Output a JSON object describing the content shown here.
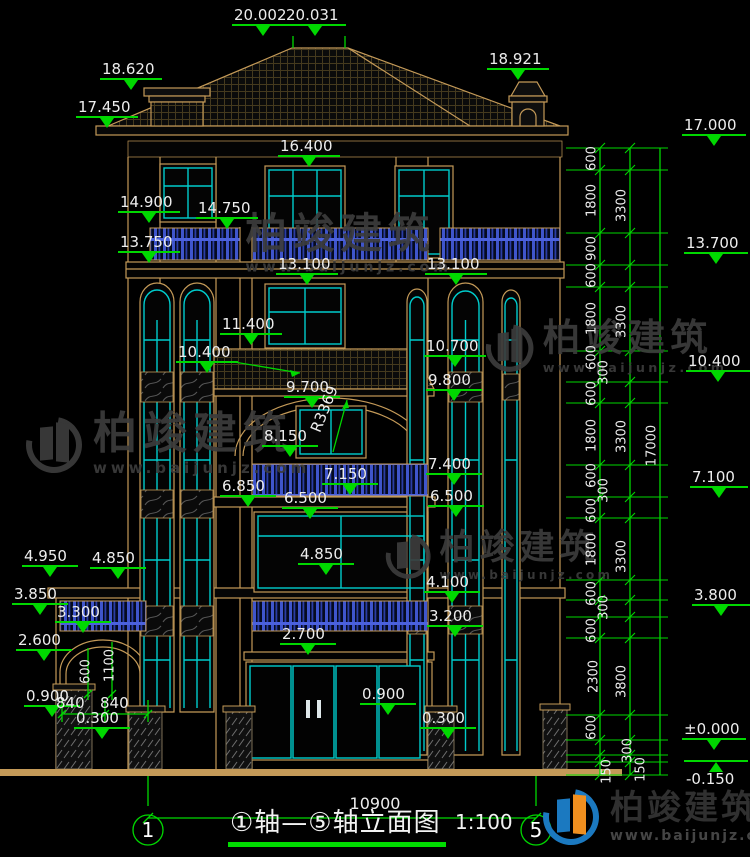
{
  "meta": {
    "drawing_type": "elevation",
    "bottom_dim": "10900"
  },
  "title": {
    "cn": "①轴—⑤轴立面图",
    "scale": "1:100",
    "axis_left": "1",
    "axis_right": "5"
  },
  "colors": {
    "background": "#000000",
    "dim_green": "#00d800",
    "line_tan": "#c49a58",
    "window_cyan": "#00cccc",
    "baluster_blue": "#3f55cc",
    "text_white": "#ededed",
    "watermark_gray": "#3c3c3c",
    "logo_blue": "#1b79c0",
    "logo_orange": "#ef8f1f"
  },
  "elevation_markers": [
    {
      "label": "20.002",
      "x": 232,
      "y": 8
    },
    {
      "label": "20.031",
      "x": 284,
      "y": 8
    },
    {
      "label": "18.620",
      "x": 100,
      "y": 62
    },
    {
      "label": "18.921",
      "x": 487,
      "y": 52
    },
    {
      "label": "17.450",
      "x": 76,
      "y": 100
    },
    {
      "label": "16.400",
      "x": 278,
      "y": 139
    },
    {
      "label": "14.900",
      "x": 118,
      "y": 195
    },
    {
      "label": "14.750",
      "x": 196,
      "y": 201
    },
    {
      "label": "13.750",
      "x": 118,
      "y": 235
    },
    {
      "label": "13.100",
      "x": 276,
      "y": 257
    },
    {
      "label": "13.100",
      "x": 425,
      "y": 257
    },
    {
      "label": "11.400",
      "x": 220,
      "y": 317
    },
    {
      "label": "10.400",
      "x": 176,
      "y": 345
    },
    {
      "label": "10.700",
      "x": 424,
      "y": 339
    },
    {
      "label": "9.800",
      "x": 426,
      "y": 373,
      "w": 56
    },
    {
      "label": "9.700",
      "x": 284,
      "y": 380,
      "w": 56
    },
    {
      "label": "8.150",
      "x": 262,
      "y": 429,
      "w": 56
    },
    {
      "label": "7.400",
      "x": 426,
      "y": 457,
      "w": 56
    },
    {
      "label": "7.150",
      "x": 322,
      "y": 467,
      "w": 56
    },
    {
      "label": "6.850",
      "x": 220,
      "y": 479,
      "w": 56
    },
    {
      "label": "6.500",
      "x": 282,
      "y": 491,
      "w": 56
    },
    {
      "label": "6.500",
      "x": 428,
      "y": 489,
      "w": 56
    },
    {
      "label": "4.950",
      "x": 22,
      "y": 549,
      "w": 56
    },
    {
      "label": "4.850",
      "x": 90,
      "y": 551,
      "w": 56
    },
    {
      "label": "4.850",
      "x": 298,
      "y": 547,
      "w": 56
    },
    {
      "label": "3.850",
      "x": 12,
      "y": 587,
      "w": 56
    },
    {
      "label": "3.300",
      "x": 55,
      "y": 605,
      "w": 56
    },
    {
      "label": "4.100",
      "x": 424,
      "y": 575,
      "w": 56
    },
    {
      "label": "3.200",
      "x": 427,
      "y": 609,
      "w": 56
    },
    {
      "label": "2.600",
      "x": 16,
      "y": 633,
      "w": 56
    },
    {
      "label": "2.700",
      "x": 280,
      "y": 627,
      "w": 56
    },
    {
      "label": "0.900",
      "x": 24,
      "y": 689,
      "w": 56
    },
    {
      "label": "0.300",
      "x": 74,
      "y": 711,
      "w": 56
    },
    {
      "label": "0.900",
      "x": 360,
      "y": 687,
      "w": 56
    },
    {
      "label": "0.300",
      "x": 420,
      "y": 711,
      "w": 56
    },
    {
      "label": "17.000",
      "x": 682,
      "y": 118,
      "w": 64
    },
    {
      "label": "13.700",
      "x": 684,
      "y": 236,
      "w": 64
    },
    {
      "label": "10.400",
      "x": 686,
      "y": 354,
      "w": 64
    },
    {
      "label": "7.100",
      "x": 690,
      "y": 470,
      "w": 58
    },
    {
      "label": "3.800",
      "x": 692,
      "y": 588,
      "w": 58
    },
    {
      "label": "±0.000",
      "x": 682,
      "y": 722,
      "w": 64
    },
    {
      "label": "-0.150",
      "x": 684,
      "y": 760,
      "w": 64,
      "below": true
    }
  ],
  "right_chain": {
    "tier1": [
      {
        "v": "600",
        "x": 592,
        "y": 159
      },
      {
        "v": "1800",
        "x": 592,
        "y": 201
      },
      {
        "v": "900",
        "x": 592,
        "y": 249
      },
      {
        "v": "600",
        "x": 592,
        "y": 276
      },
      {
        "v": "1800",
        "x": 592,
        "y": 319
      },
      {
        "v": "600",
        "x": 592,
        "y": 358
      },
      {
        "v": "300",
        "x": 604,
        "y": 373
      },
      {
        "v": "600",
        "x": 592,
        "y": 394
      },
      {
        "v": "1800",
        "x": 592,
        "y": 436
      },
      {
        "v": "600",
        "x": 592,
        "y": 476
      },
      {
        "v": "300",
        "x": 604,
        "y": 491
      },
      {
        "v": "600",
        "x": 592,
        "y": 511
      },
      {
        "v": "1800",
        "x": 592,
        "y": 550
      },
      {
        "v": "600",
        "x": 592,
        "y": 594
      },
      {
        "v": "300",
        "x": 604,
        "y": 608
      },
      {
        "v": "600",
        "x": 592,
        "y": 631
      },
      {
        "v": "2300",
        "x": 594,
        "y": 677
      },
      {
        "v": "600",
        "x": 592,
        "y": 728
      },
      {
        "v": "150",
        "x": 607,
        "y": 772
      }
    ],
    "tier2": [
      {
        "v": "3300",
        "x": 622,
        "y": 206
      },
      {
        "v": "3300",
        "x": 622,
        "y": 322
      },
      {
        "v": "3300",
        "x": 622,
        "y": 437
      },
      {
        "v": "3300",
        "x": 622,
        "y": 557
      },
      {
        "v": "3800",
        "x": 622,
        "y": 682
      },
      {
        "v": "300",
        "x": 628,
        "y": 751
      },
      {
        "v": "150",
        "x": 641,
        "y": 770
      }
    ],
    "tier3": [
      {
        "v": "17000",
        "x": 652,
        "y": 446
      }
    ],
    "ticks_y": [
      148,
      170,
      233,
      265,
      287,
      351,
      382,
      403,
      465,
      497,
      518,
      580,
      600,
      617,
      638,
      715,
      740,
      755,
      762,
      775
    ]
  },
  "inner_dims": {
    "arch_h1": {
      "v": "600",
      "x": 86,
      "y": 672
    },
    "arch_h2": {
      "v": "1100",
      "x": 110,
      "y": 666
    },
    "left_840": "840",
    "right_840": "840",
    "radius": "R3369"
  },
  "watermark": {
    "cn": "柏竣建筑",
    "url": "www.baijunjz.com"
  }
}
